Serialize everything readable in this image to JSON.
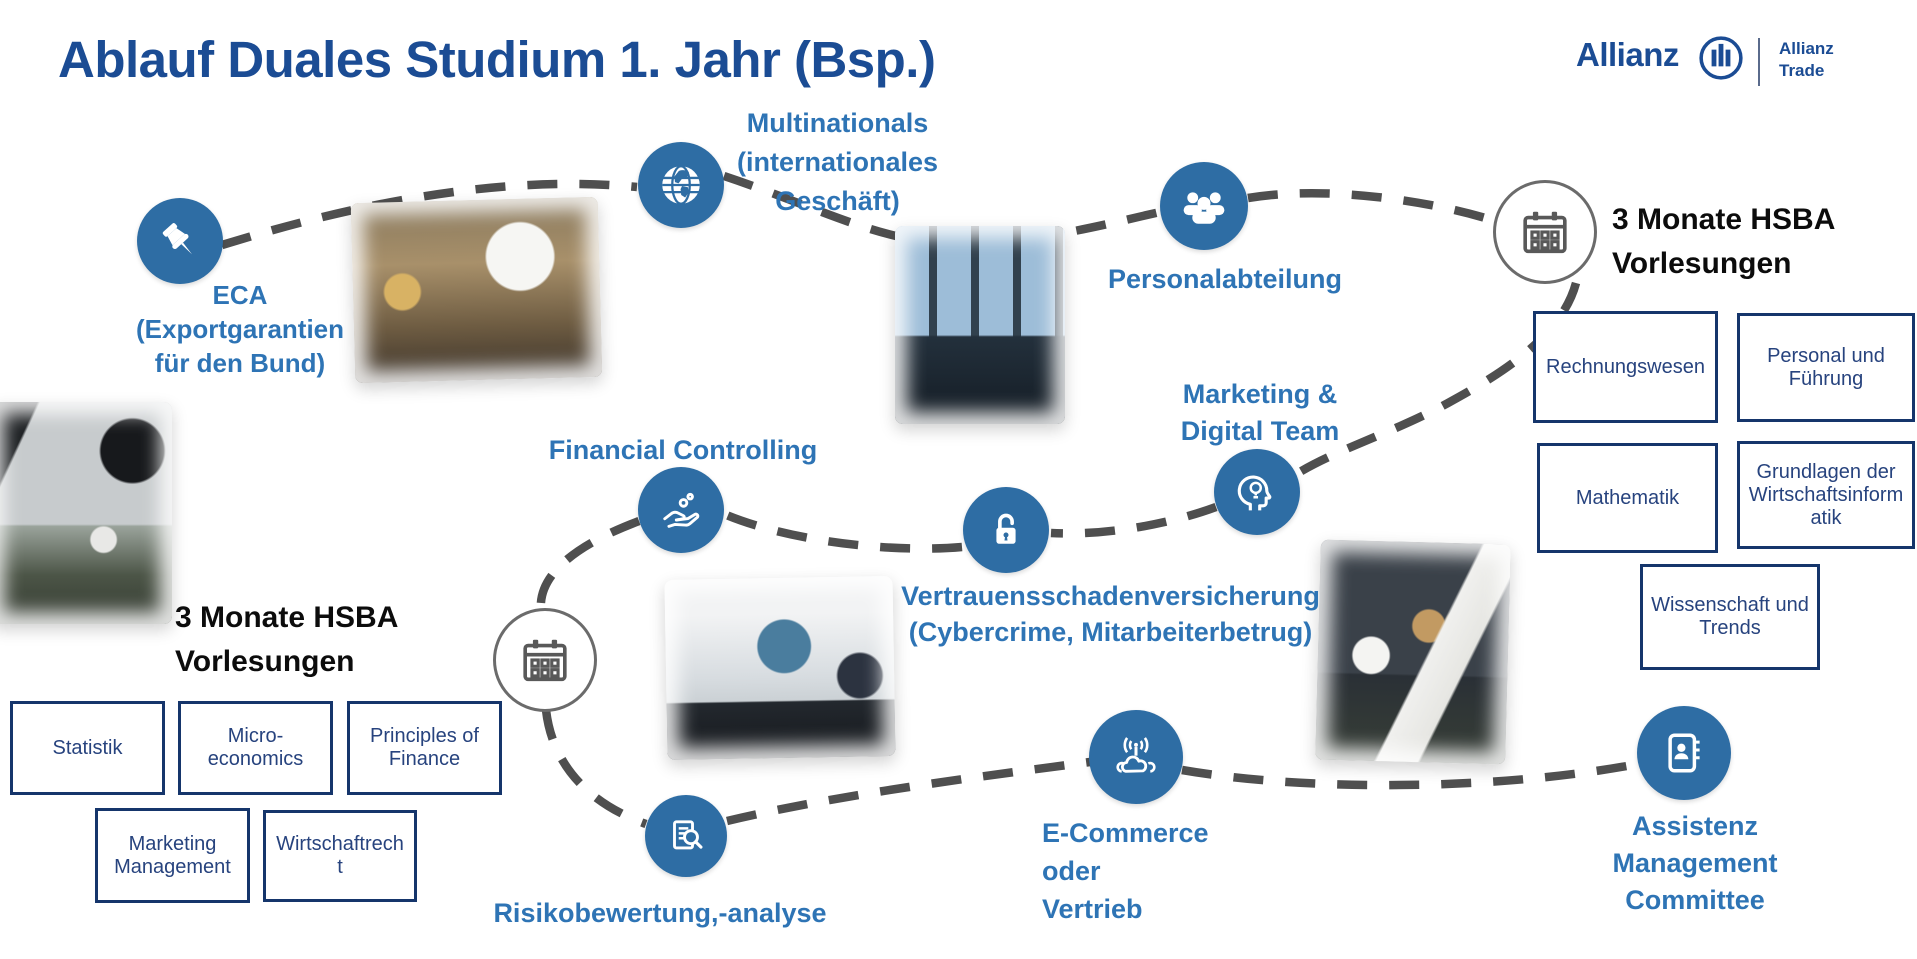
{
  "slide": {
    "title": "Ablauf Duales Studium 1. Jahr (Bsp.)"
  },
  "logo": {
    "brand": "Allianz",
    "unit": [
      "Allianz",
      "Trade"
    ]
  },
  "colors": {
    "title_navy": "#1b4c94",
    "station_circle_blue": "#2e6da4",
    "label_blue": "#2e74b5",
    "box_border_navy": "#15356b",
    "box_text_navy": "#27437e",
    "route_dash_gray": "#4f4f4f",
    "black_label": "#0c0c0c"
  },
  "stations": {
    "eca": {
      "icon": "pushpin-icon",
      "lines": [
        "ECA",
        "(Exportgarantien",
        "für den Bund)"
      ]
    },
    "multinationals": {
      "icon": "globe-icon",
      "lines": [
        "Multinationals",
        "(internationales",
        "Geschäft)"
      ]
    },
    "personalabteilung": {
      "icon": "people-group-icon",
      "label": "Personalabteilung"
    },
    "hsba_right": {
      "icon": "calendar-icon",
      "lines": [
        "3 Monate HSBA",
        "Vorlesungen"
      ],
      "courses": [
        "Rechnungswesen",
        "Personal und Führung",
        "Mathematik",
        "Grundlagen der Wirtschaftsinformatik",
        "Wissenschaft und Trends"
      ]
    },
    "marketing_digital": {
      "icon": "head-lightbulb-icon",
      "lines": [
        "Marketing &",
        "Digital Team"
      ]
    },
    "vertrauensschaden": {
      "icon": "open-padlock-icon",
      "lines": [
        "Vertrauensschadenversicherung",
        "(Cybercrime, Mitarbeiterbetrug)"
      ]
    },
    "financial_controlling": {
      "icon": "hand-coins-icon",
      "label": "Financial Controlling"
    },
    "hsba_left": {
      "icon": "calendar-icon",
      "lines": [
        "3 Monate HSBA",
        "Vorlesungen"
      ],
      "courses": [
        "Statistik",
        "Micro-economics",
        "Principles of Finance",
        "Marketing Management",
        "Wirtschaftrecht"
      ]
    },
    "risikobewertung": {
      "icon": "document-search-icon",
      "label": "Risikobewertung,-analyse"
    },
    "ecommerce": {
      "icon": "cloud-network-icon",
      "lines": [
        "E-Commerce",
        "oder",
        "Vertrieb"
      ]
    },
    "assistenz": {
      "icon": "contact-book-icon",
      "lines": [
        "Assistenz",
        "Management",
        "Committee"
      ]
    }
  }
}
